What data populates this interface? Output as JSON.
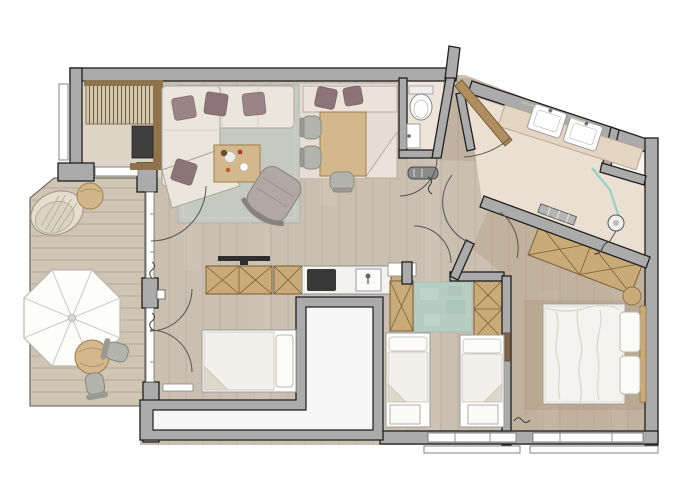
{
  "meta": {
    "kind": "apartment-floor-plan",
    "view": "top-down architectural drawing",
    "visible_text": []
  },
  "palette": {
    "wall": "#ababab",
    "wall_outline": "#1f1f1f",
    "floor_wood": "#cabfb1",
    "plank_line": "#b2a291",
    "floor_bath": "#ebdfd2",
    "floor_wc": "#eee4da",
    "floor_entry": "#ddd3c6",
    "deck": "#cfc5b2",
    "deck_line": "#b5a893",
    "rug_living": "#c6c9c1",
    "rug_kids": "#b6cdc4",
    "sofa": "#eae6dc",
    "pillow": "#9b8488",
    "pillow_dark": "#8d7478",
    "cabinet": "#c9aa78",
    "cabinet_line": "#7a603a",
    "counter": "#f3f2ef",
    "cooktop": "#383838",
    "bed_linen": "#f5f3ef",
    "bench_pink": "#ece2da",
    "mat_pink": "#e7dcd6",
    "chair_gray": "#b4b4ae",
    "glass": "#96cfc7",
    "door_wood": "#b08d5f",
    "umbrella": "#fdfdfc",
    "void_fill": "#f7f7f7",
    "wood_furniture": "#d2b88c"
  },
  "rooms": [
    {
      "id": "living-room",
      "furniture": [
        "corner-sofa",
        "throw-pillows",
        "coffee-table",
        "armchair",
        "area-rug",
        "tv-sideboard"
      ]
    },
    {
      "id": "dining-corner",
      "furniture": [
        "l-shaped-bench",
        "seat-cushions",
        "dining-table",
        "three-chairs"
      ]
    },
    {
      "id": "kitchen",
      "furniture": [
        "base-cabinets",
        "cooktop",
        "sink-with-faucet"
      ]
    },
    {
      "id": "entry",
      "furniture": [
        "built-in-wardrobe",
        "dark-wall-panel"
      ]
    },
    {
      "id": "wc",
      "furniture": [
        "toilet",
        "small-washbasin"
      ]
    },
    {
      "id": "bathroom",
      "furniture": [
        "double-vanity",
        "washbasin",
        "washbasin",
        "glass-shower-screen",
        "shower-head",
        "towel-radiator",
        "storage-niche"
      ]
    },
    {
      "id": "master-bedroom",
      "furniture": [
        "double-bed",
        "two-pillows",
        "headboard",
        "angled-wardrobe",
        "round-stool",
        "rug"
      ]
    },
    {
      "id": "kids-bedroom",
      "furniture": [
        "single-bed",
        "single-bed",
        "foot-bench",
        "foot-bench",
        "rug",
        "wardrobe",
        "wardrobe"
      ]
    },
    {
      "id": "sleeping-nook",
      "furniture": [
        "double-bed"
      ]
    },
    {
      "id": "hallway",
      "furniture": [
        "console-bench",
        "entrance-door"
      ]
    },
    {
      "id": "terrace",
      "furniture": [
        "deck-boards",
        "parasol",
        "round-table",
        "two-chairs",
        "hanging-egg-chair",
        "side-table"
      ]
    },
    {
      "id": "building-void",
      "furniture": []
    }
  ],
  "symbols": [
    "door-swing-arc",
    "window-band",
    "wall-break-squiggle",
    "entrance-door-leaf",
    "wall"
  ]
}
